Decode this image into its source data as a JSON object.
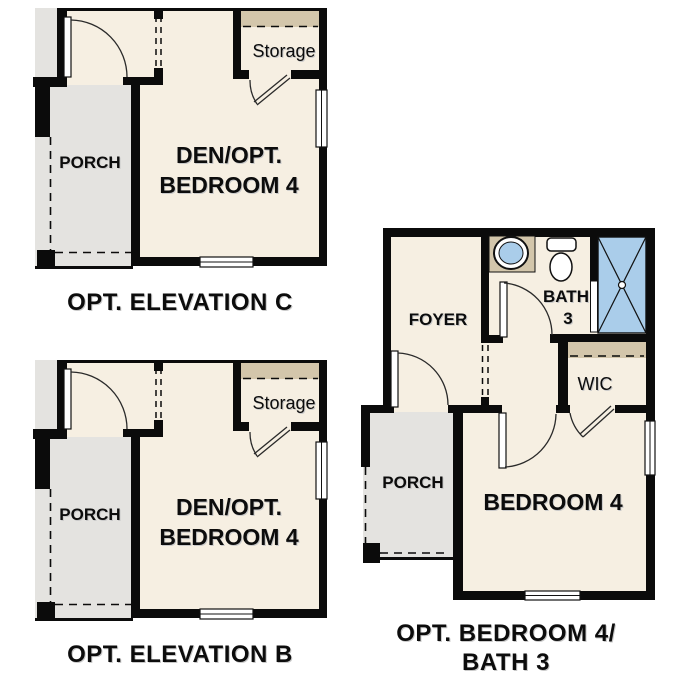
{
  "colors": {
    "room_fill": "#f6efe2",
    "porch_fill": "#e4e3e0",
    "closet_header_fill": "#d3c6ab",
    "shower_fill": "#aacdea",
    "wall": "#0b0b0b",
    "text": "#0c0c0c"
  },
  "plans": {
    "elevation_c": {
      "caption": "OPT. ELEVATION C",
      "porch": "PORCH",
      "den_line1": "DEN/OPT.",
      "den_line2": "BEDROOM 4",
      "storage": "Storage"
    },
    "elevation_b": {
      "caption": "OPT. ELEVATION B",
      "porch": "PORCH",
      "den_line1": "DEN/OPT.",
      "den_line2": "BEDROOM 4",
      "storage": "Storage"
    },
    "opt_bedroom4_bath3": {
      "caption_line1": "OPT. BEDROOM 4/",
      "caption_line2": "BATH 3",
      "foyer": "FOYER",
      "bath_line1": "BATH",
      "bath_line2": "3",
      "wic": "WIC",
      "porch": "PORCH",
      "bedroom": "BEDROOM 4"
    }
  }
}
